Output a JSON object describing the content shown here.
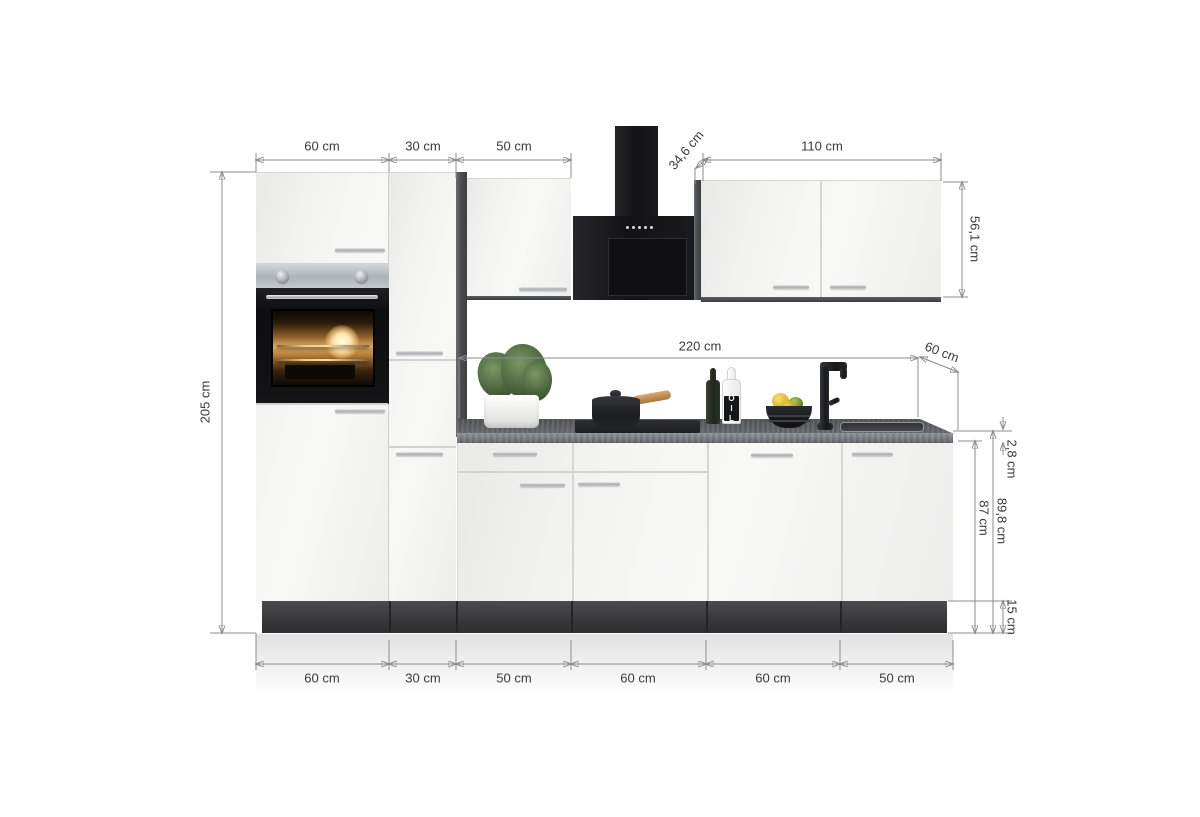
{
  "dims": {
    "top_widths": [
      "60 cm",
      "30 cm",
      "50 cm"
    ],
    "wall_width": "110 cm",
    "hood_depth": "34,6 cm",
    "wall_height": "56,1 cm",
    "total_height": "205 cm",
    "counter_width": "220 cm",
    "counter_depth": "60 cm",
    "counter_thickness": "2,8 cm",
    "base_height": "87 cm",
    "counter_level_height": "89,8 cm",
    "plinth_height": "15 cm",
    "bottom_widths": [
      "60 cm",
      "30 cm",
      "50 cm",
      "60 cm",
      "60 cm",
      "50 cm"
    ]
  },
  "items": {
    "oil_label": "OIL"
  },
  "colors": {
    "cabinet": "#f2f2f1",
    "dark-panel": "#3f4043",
    "plinth": "#3d3d40",
    "countertop": "#606366",
    "hood": "#1a1a1c",
    "dim-line": "#8c8c8c",
    "dim-text": "#3a3a3a",
    "wood": "#c89a5f"
  }
}
